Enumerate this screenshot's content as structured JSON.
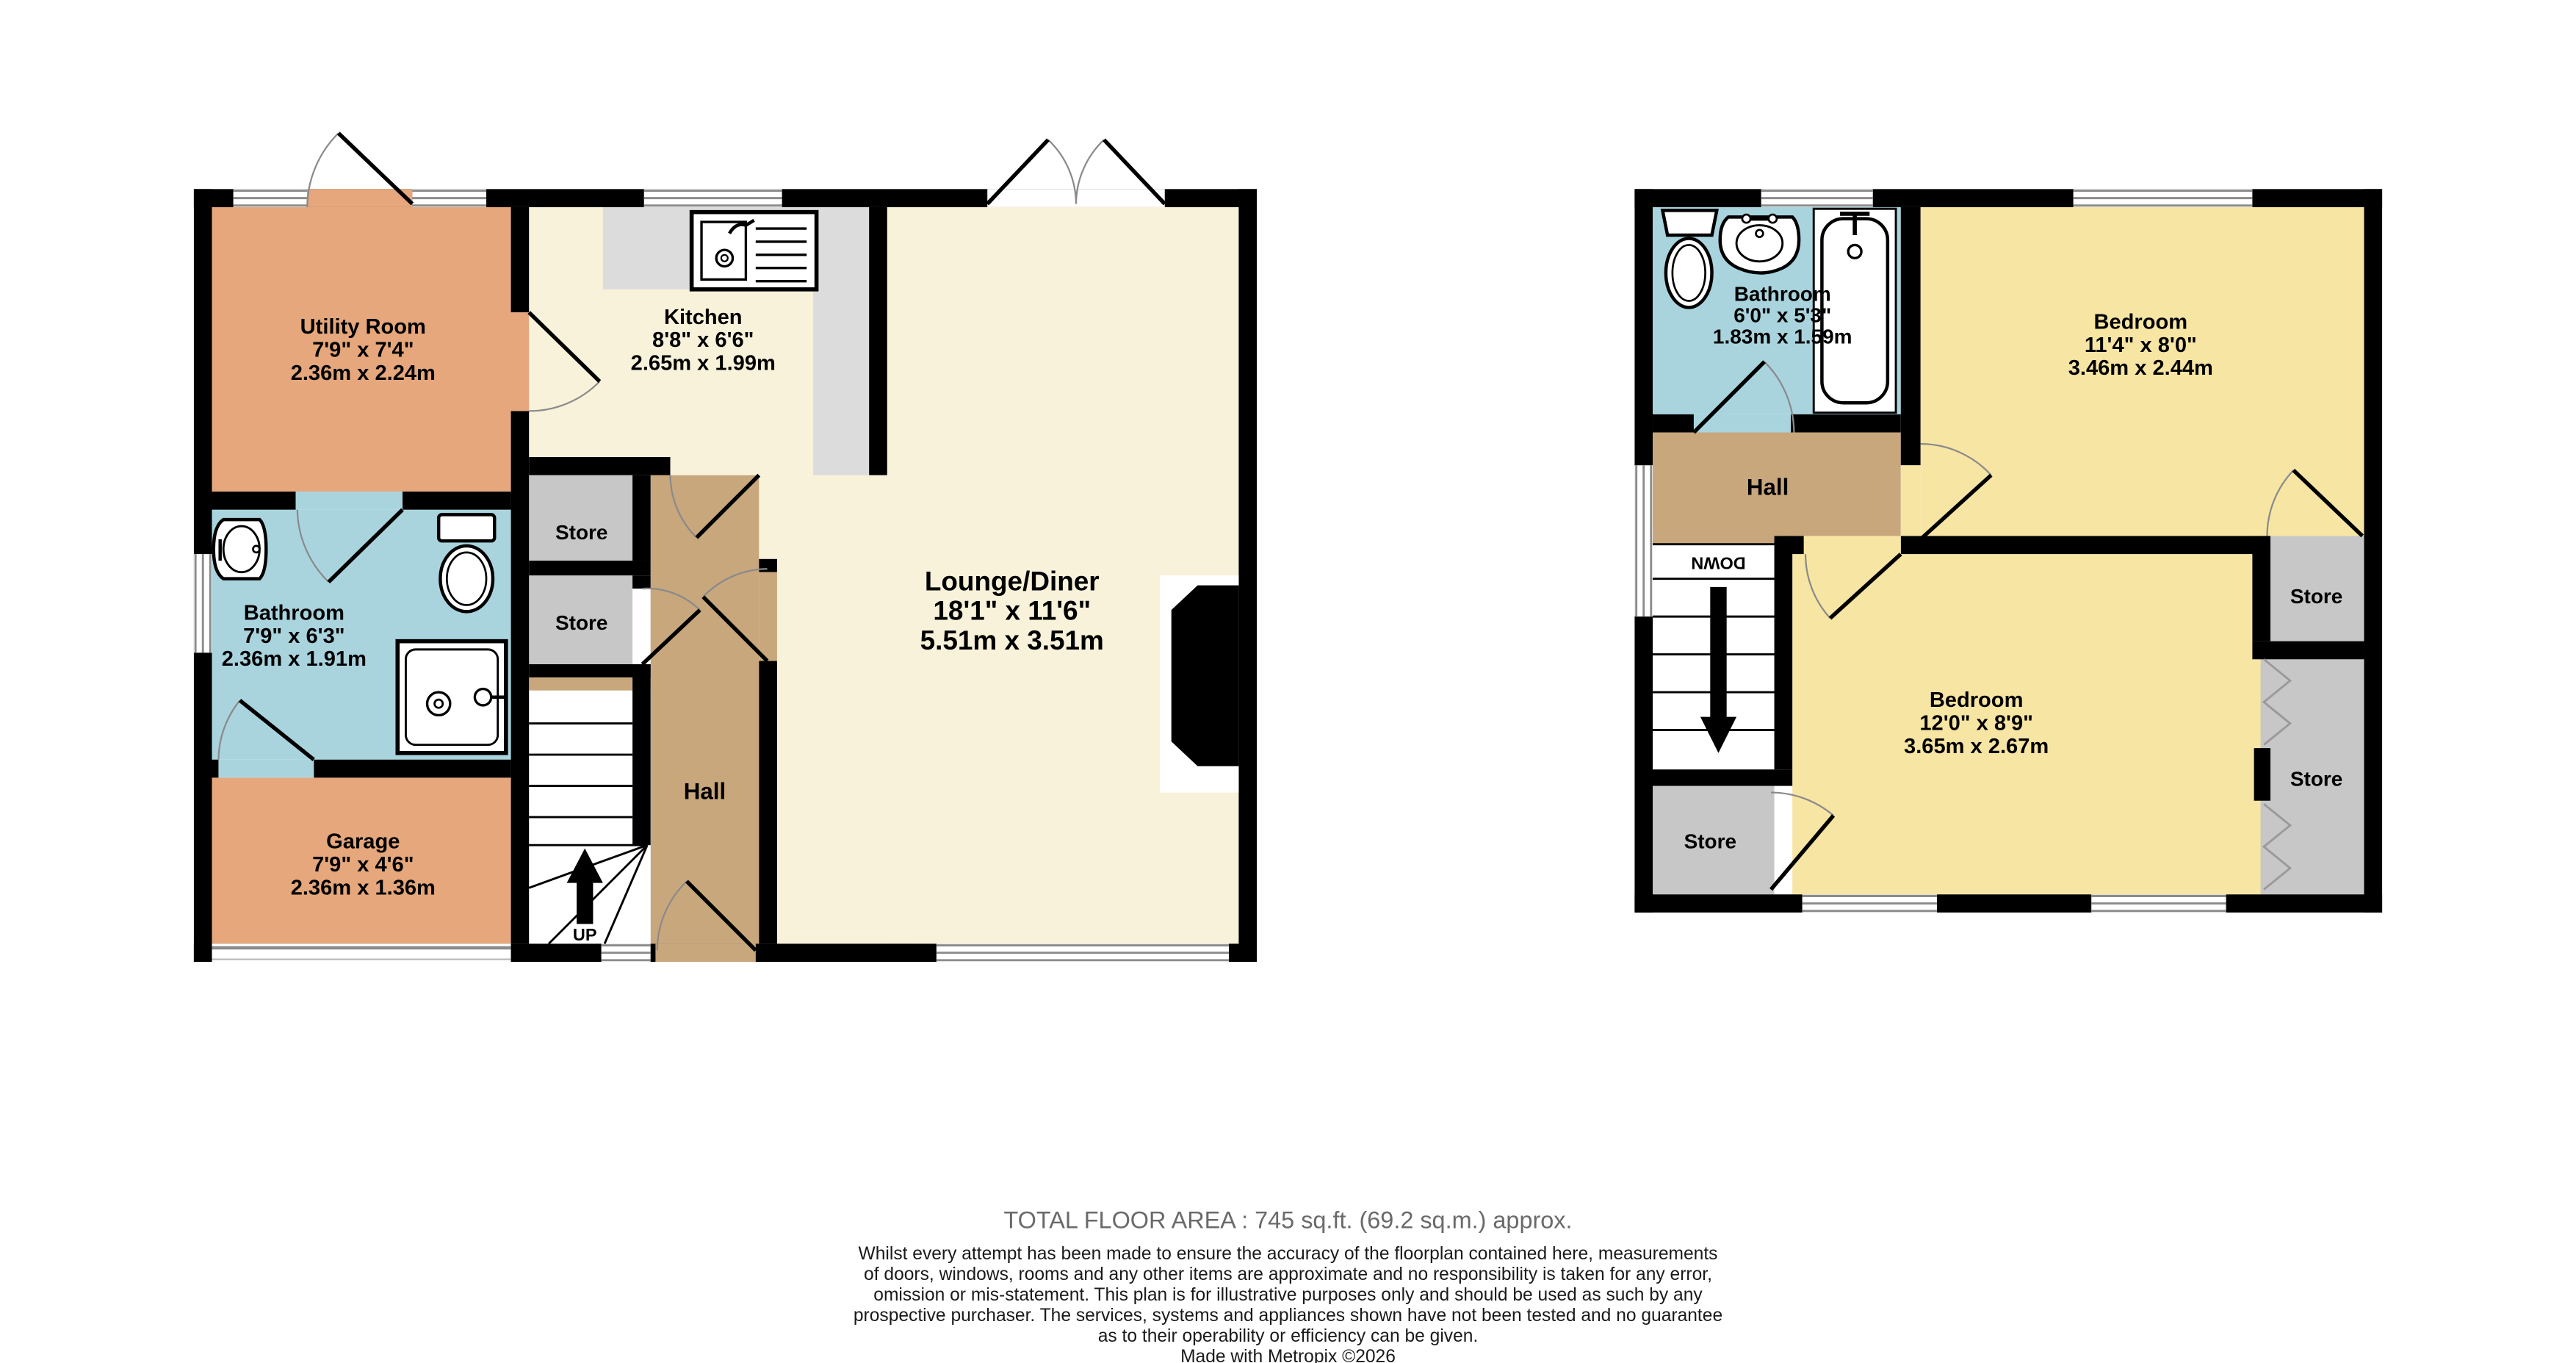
{
  "floorplan": {
    "ground_floor": {
      "utility": {
        "name": "Utility Room",
        "imperial": "7'9\" x 7'4\"",
        "metric": "2.36m x 2.24m"
      },
      "kitchen": {
        "name": "Kitchen",
        "imperial": "8'8\" x 6'6\"",
        "metric": "2.65m x 1.99m"
      },
      "lounge_diner": {
        "name": "Lounge/Diner",
        "imperial": "18'1\" x 11'6\"",
        "metric": "5.51m x 3.51m"
      },
      "bathroom": {
        "name": "Bathroom",
        "imperial": "7'9\" x 6'3\"",
        "metric": "2.36m x 1.91m"
      },
      "garage": {
        "name": "Garage",
        "imperial": "7'9\" x 4'6\"",
        "metric": "2.36m x 1.36m"
      },
      "hall": {
        "name": "Hall"
      },
      "store_upper": {
        "name": "Store"
      },
      "store_lower": {
        "name": "Store"
      },
      "stairs_label": "UP"
    },
    "first_floor": {
      "bathroom": {
        "name": "Bathroom",
        "imperial": "6'0\" x 5'3\"",
        "metric": "1.83m x 1.59m"
      },
      "bedroom_front": {
        "name": "Bedroom",
        "imperial": "11'4\" x 8'0\"",
        "metric": "3.46m x 2.44m"
      },
      "bedroom_back": {
        "name": "Bedroom",
        "imperial": "12'0\" x 8'9\"",
        "metric": "3.65m x 2.67m"
      },
      "hall": {
        "name": "Hall"
      },
      "store_right_upper": {
        "name": "Store"
      },
      "store_right_lower": {
        "name": "Store"
      },
      "store_left": {
        "name": "Store"
      },
      "stairs_label": "DOWN"
    },
    "colors": {
      "wall": "#000000",
      "utility_garage": "#E5A77B",
      "kitchen_lounge": "#F8F2DB",
      "bathroom": "#A9D4DE",
      "hall": "#C8A77D",
      "store": "#C7C7C7",
      "bedroom": "#F7E5A4",
      "counter": "#DCDCDC",
      "window_line": "#8C8C8C",
      "footer_gray": "#6A6A6A"
    }
  },
  "footer": {
    "total_area": "TOTAL FLOOR AREA : 745 sq.ft. (69.2 sq.m.) approx.",
    "disclaimer_lines": [
      "Whilst every attempt has been made to ensure the accuracy of the floorplan contained here, measurements",
      "of doors, windows, rooms and any other items are approximate and no responsibility is taken for any error,",
      "omission or mis-statement. This plan is for illustrative purposes only and should be used as such by any",
      "prospective purchaser. The services, systems and appliances shown have not been tested and no guarantee",
      "as to their operability or efficiency can be given."
    ],
    "credit": "Made with Metropix ©2026"
  }
}
